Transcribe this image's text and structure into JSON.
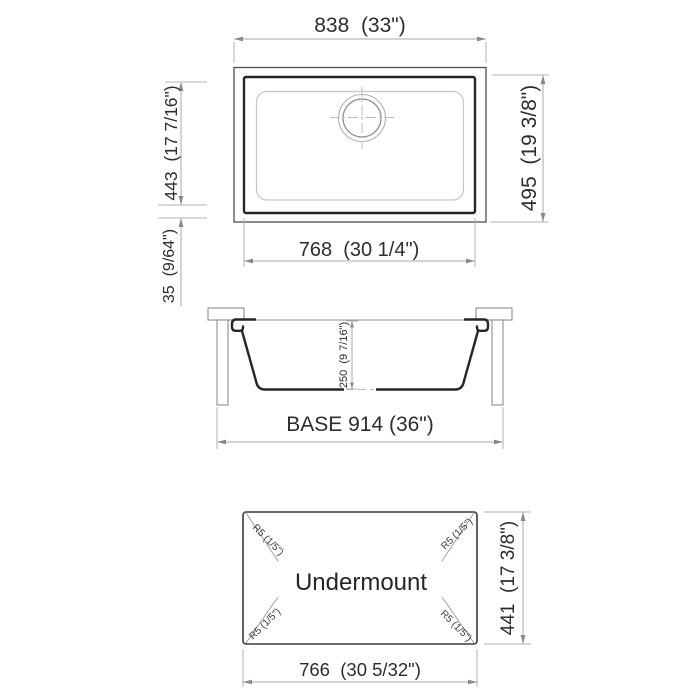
{
  "colors": {
    "background": "#ffffff",
    "bold_outline": "#262626",
    "frame_outline": "#4f4f4f",
    "light_outline": "#c6c6c6",
    "dimension_lines": "#a8a8a8",
    "text": "#2d2d2d"
  },
  "top_view": {
    "dim_overall_width": "838  (33\")",
    "dim_overall_depth": "495  (19 3/8\")",
    "dim_bowl_width": "768  (30 1/4\")",
    "dim_bowl_depth": "443  (17 7/16\")",
    "dim_rim_gap": "35  (9/64\")"
  },
  "section_view": {
    "dim_bowl_height": "250  (9 7/16\")",
    "dim_base_cabinet": "BASE 914 (36\")"
  },
  "bottom_view": {
    "mount_type_label": "Undermount",
    "dim_bottom_width": "766  (30 5/32\")",
    "dim_bottom_depth": "441  (17 3/8\")",
    "corner_radius_tl": "R5 (1/5\")",
    "corner_radius_tr": "R5 (1/5\")",
    "corner_radius_bl": "R5 (1/5\")",
    "corner_radius_br": "R5 (1/5\")"
  }
}
